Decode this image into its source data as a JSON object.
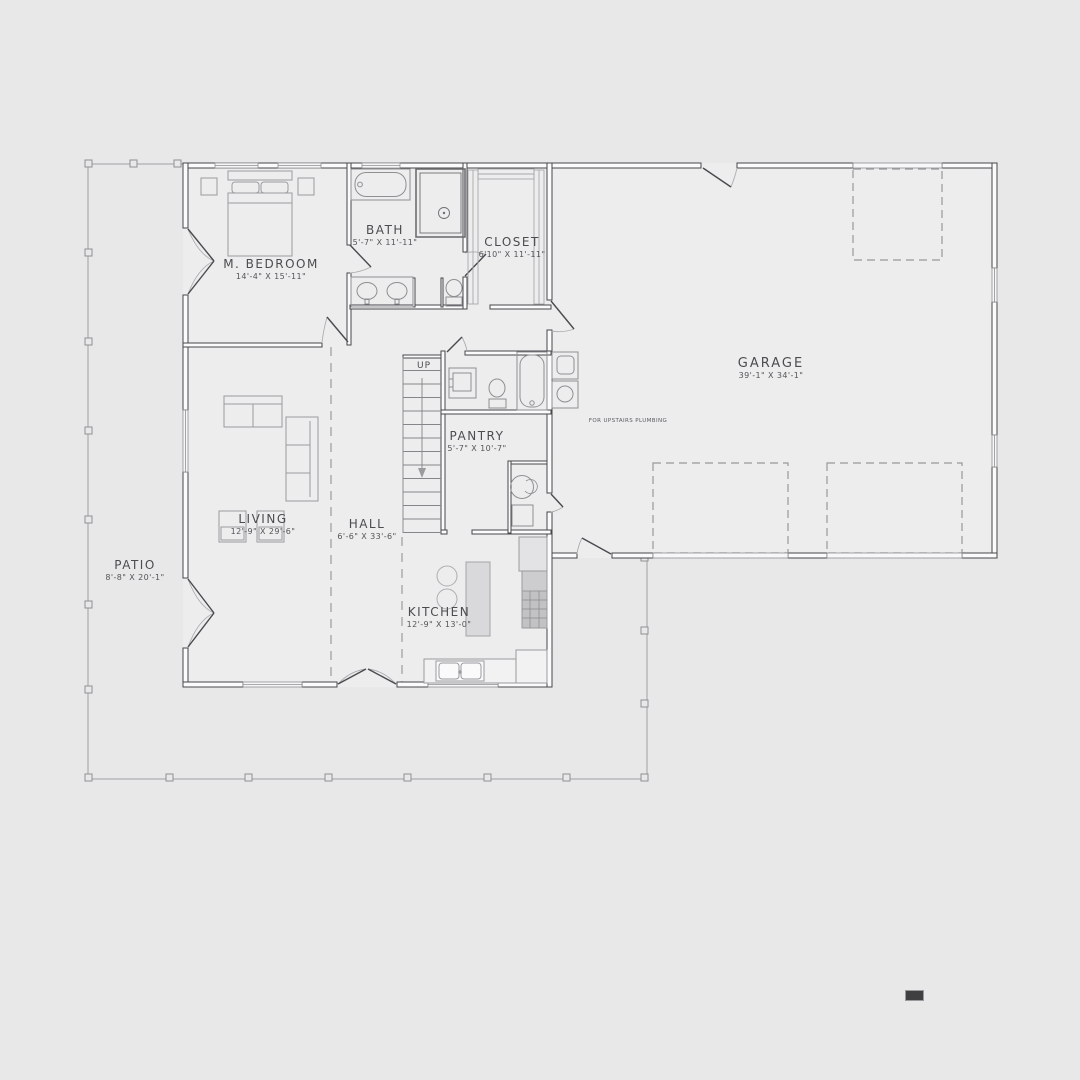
{
  "title": "First floor plan",
  "rooms": [
    {
      "id": "m-bedroom",
      "name": "M. BEDROOM",
      "dims": "14'-4\" X 15'-11\""
    },
    {
      "id": "bath",
      "name": "BATH",
      "dims": "5'-7\" X 11'-11\""
    },
    {
      "id": "closet",
      "name": "CLOSET",
      "dims": "6'10\" X 11'-11\""
    },
    {
      "id": "garage",
      "name": "GARAGE",
      "dims": "39'-1\" X 34'-1\""
    },
    {
      "id": "pantry",
      "name": "PANTRY",
      "dims": "5'-7\" X 10'-7\""
    },
    {
      "id": "living",
      "name": "LIVING",
      "dims": "12'-9\" X 29'-6\""
    },
    {
      "id": "hall",
      "name": "HALL",
      "dims": "6'-6\" X 33'-6\""
    },
    {
      "id": "patio",
      "name": "PATIO",
      "dims": "8'-8\" X 20'-1\""
    },
    {
      "id": "kitchen",
      "name": "KITCHEN",
      "dims": "12'-9\" X 13'-0\""
    }
  ],
  "annotations": {
    "stairs_direction": "UP",
    "plumbing_note": "FOR UPSTAIRS PLUMBING"
  },
  "colors": {
    "background": "#e8e8e9",
    "interior_fill": "#ededee",
    "wall_line": "#47474b",
    "light_line": "#9b9b9f",
    "text": "#4c4c50"
  }
}
